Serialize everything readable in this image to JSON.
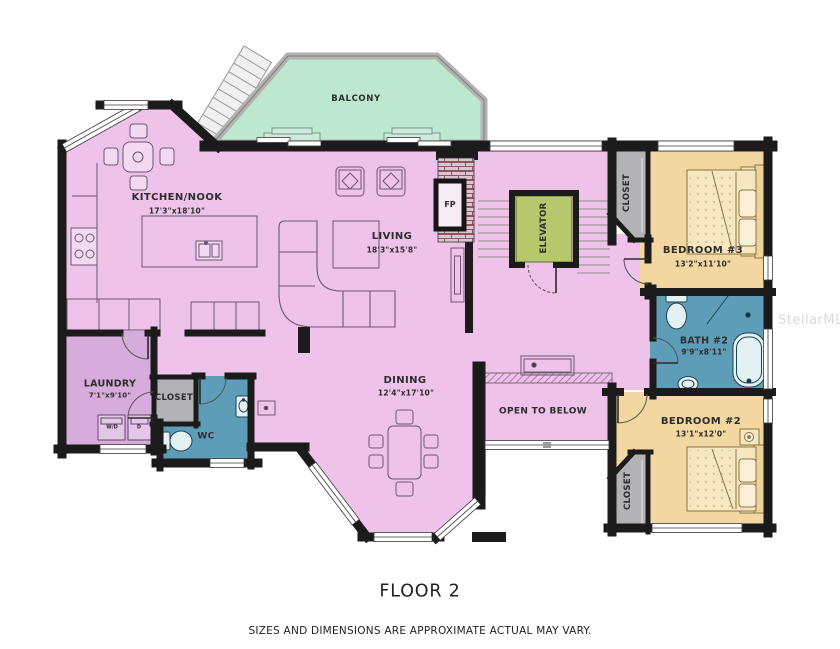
{
  "floor_title": "FLOOR 2",
  "disclaimer": "SIZES AND DIMENSIONS ARE APPROXIMATE ACTUAL MAY VARY.",
  "watermark": "StellarMLS",
  "rooms": {
    "balcony": {
      "name": "BALCONY"
    },
    "kitchen": {
      "name": "KITCHEN/NOOK",
      "dims": "17'3\"x18'10\""
    },
    "living": {
      "name": "LIVING",
      "dims": "18'3\"x15'8\""
    },
    "dining": {
      "name": "DINING",
      "dims": "12'4\"x17'10\""
    },
    "open_to_below": {
      "name": "OPEN TO BELOW"
    },
    "elevator": {
      "name": "ELEVATOR"
    },
    "fireplace": {
      "name": "FP"
    },
    "laundry": {
      "name": "LAUNDRY",
      "dims": "7'1\"x9'10\""
    },
    "wc": {
      "name": "WC"
    },
    "closet_hall": {
      "name": "CLOSET"
    },
    "closet_bedroom3": {
      "name": "CLOSET"
    },
    "closet_bedroom2": {
      "name": "CLOSET"
    },
    "bedroom3": {
      "name": "BEDROOM #3",
      "dims": "13'2\"x11'10\""
    },
    "bath2": {
      "name": "BATH #2",
      "dims": "9'9\"x8'11\""
    },
    "bedroom2": {
      "name": "BEDROOM #2",
      "dims": "13'1\"x12'0\""
    }
  },
  "appliances": {
    "washer": "W/D",
    "dryer": "D"
  },
  "colors": {
    "floor_pink": "#efc2ea",
    "laundry_purple": "#d7abdb",
    "balcony_green": "#bee7cf",
    "bedroom_tan": "#f2d7a1",
    "bath_blue": "#5e9db7",
    "elevator_green": "#b5c96c",
    "closet_gray": "#b3b2b5",
    "wall_black": "#1b1b1b"
  }
}
